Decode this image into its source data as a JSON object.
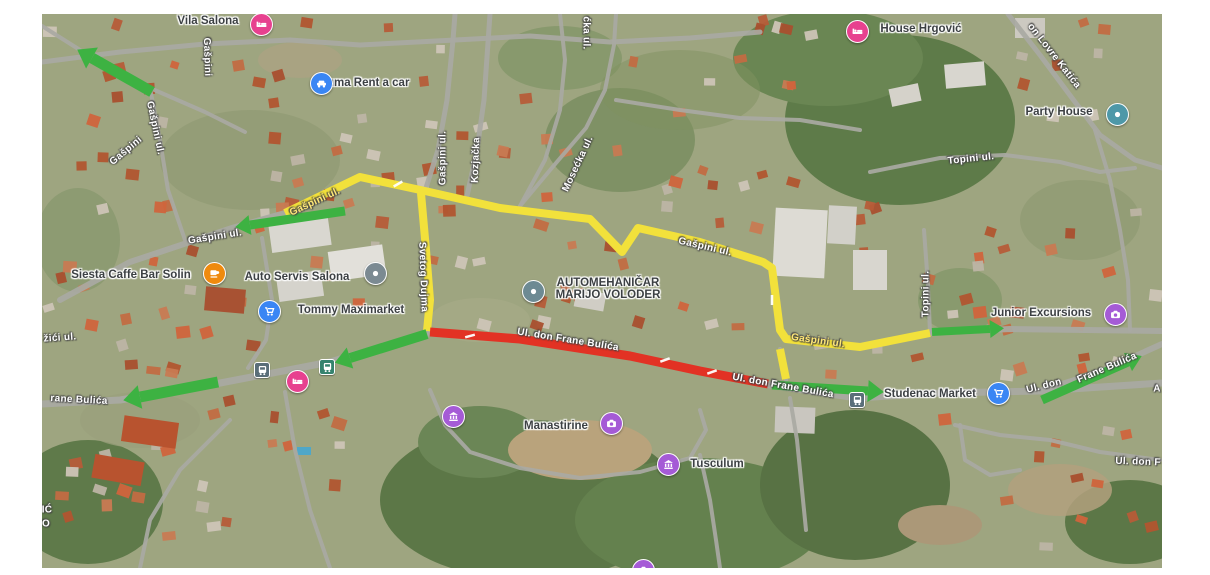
{
  "map": {
    "colors": {
      "traffic_green": "#3db242",
      "traffic_yellow": "#f2e13b",
      "traffic_red": "#e23224",
      "road": "#a9a9a3",
      "land": "#9ea580"
    },
    "street_labels": [
      {
        "text": "žići ul.",
        "x": 60,
        "y": 338,
        "rot": -4,
        "style": "white"
      },
      {
        "text": "rane Bulića",
        "x": 79,
        "y": 400,
        "rot": 3,
        "style": "white"
      },
      {
        "text": "Gašpini ul.",
        "x": 215,
        "y": 237,
        "rot": -9,
        "style": "white"
      },
      {
        "text": "Gašpini ul.",
        "x": 315,
        "y": 202,
        "rot": -25,
        "style": "on-yellow"
      },
      {
        "text": "Gašpini",
        "x": 207,
        "y": 57,
        "rot": 88,
        "style": "white"
      },
      {
        "text": "Gašpini ul.",
        "x": 155,
        "y": 128,
        "rot": 78,
        "style": "white"
      },
      {
        "text": "Gašpini",
        "x": 126,
        "y": 151,
        "rot": -40,
        "style": "white"
      },
      {
        "text": "Gašpini ul.",
        "x": 443,
        "y": 158,
        "rot": -90,
        "style": "white"
      },
      {
        "text": "Kozjačka",
        "x": 476,
        "y": 160,
        "rot": -88,
        "style": "white"
      },
      {
        "text": "ćka ul.",
        "x": 586,
        "y": 33,
        "rot": 90,
        "style": "white"
      },
      {
        "text": "Mosećka ul.",
        "x": 578,
        "y": 164,
        "rot": -65,
        "style": "white"
      },
      {
        "text": "Svetog Dujma",
        "x": 423,
        "y": 277,
        "rot": 88,
        "style": "white"
      },
      {
        "text": "Gašpini ul.",
        "x": 705,
        "y": 247,
        "rot": 13,
        "style": "white"
      },
      {
        "text": "Gašpini ul.",
        "x": 818,
        "y": 341,
        "rot": 8,
        "style": "on-yellow"
      },
      {
        "text": "Topini ul.",
        "x": 971,
        "y": 159,
        "rot": -6,
        "style": "white"
      },
      {
        "text": "Topini ul.",
        "x": 926,
        "y": 294,
        "rot": -90,
        "style": "white"
      },
      {
        "text": "on Lovre Katića",
        "x": 1054,
        "y": 56,
        "rot": 52,
        "style": "white"
      },
      {
        "text": "Ul. don Frane Bulića",
        "x": 568,
        "y": 340,
        "rot": 9,
        "style": "white"
      },
      {
        "text": "Ul. don Frane Bulića",
        "x": 783,
        "y": 386,
        "rot": 10,
        "style": "white"
      },
      {
        "text": "Ul. don",
        "x": 1044,
        "y": 386,
        "rot": -14,
        "style": "white"
      },
      {
        "text": "Frane Bulića",
        "x": 1107,
        "y": 368,
        "rot": -23,
        "style": "white"
      },
      {
        "text": "Ul. don F",
        "x": 1138,
        "y": 462,
        "rot": 2,
        "style": "white"
      },
      {
        "text": "A",
        "x": 1157,
        "y": 389,
        "rot": 0,
        "style": "white"
      },
      {
        "text": "IĆ",
        "x": 47,
        "y": 510,
        "rot": 0,
        "style": "white"
      },
      {
        "text": "O",
        "x": 46,
        "y": 524,
        "rot": 0,
        "style": "white"
      }
    ],
    "poi_labels": [
      {
        "name": "vila-salona",
        "text": "Vila Salona",
        "x": 208,
        "y": 21
      },
      {
        "name": "iluma-rent-a-car",
        "text": "Iluma Rent a car",
        "x": 365,
        "y": 83
      },
      {
        "name": "house-hrgovic",
        "text": "House Hrgović",
        "x": 921,
        "y": 29
      },
      {
        "name": "party-house",
        "text": "Party House",
        "x": 1059,
        "y": 112
      },
      {
        "name": "siesta-caffe-bar-solin",
        "text": "Siesta Caffe Bar Solin",
        "x": 131,
        "y": 275
      },
      {
        "name": "auto-servis-salona",
        "text": "Auto Servis Salona",
        "x": 297,
        "y": 277
      },
      {
        "name": "tommy-maximarket",
        "text": "Tommy Maximarket",
        "x": 351,
        "y": 310
      },
      {
        "name": "automehanicar-marijo-voloder",
        "text": "AUTOMEHANIČAR",
        "line2": "MARIJO VOLODER",
        "x": 608,
        "y": 289
      },
      {
        "name": "manastirine",
        "text": "Manastirine",
        "x": 556,
        "y": 426
      },
      {
        "name": "tusculum",
        "text": "Tusculum",
        "x": 717,
        "y": 464
      },
      {
        "name": "junior-excursions",
        "text": "Junior Excursions",
        "x": 1041,
        "y": 313
      },
      {
        "name": "studenac-market",
        "text": "Studenac Market",
        "x": 930,
        "y": 394
      }
    ],
    "markers": [
      {
        "name": "vila-salona",
        "icon": "bed",
        "color": "#e7418f",
        "x": 260,
        "y": 23
      },
      {
        "name": "iluma-rent-a-car",
        "icon": "car",
        "color": "#3a86f4",
        "x": 320,
        "y": 82
      },
      {
        "name": "house-hrgovic",
        "icon": "bed",
        "color": "#e7418f",
        "x": 856,
        "y": 30
      },
      {
        "name": "party-house",
        "icon": "dot",
        "color": "#4e98a8",
        "x": 1116,
        "y": 113
      },
      {
        "name": "siesta-caffe-bar-solin",
        "icon": "cup",
        "color": "#ef8a0e",
        "x": 213,
        "y": 272
      },
      {
        "name": "auto-servis-salona",
        "icon": "dot",
        "color": "#7b8a92",
        "x": 374,
        "y": 272
      },
      {
        "name": "tommy-maximarket",
        "icon": "cart",
        "color": "#3a86f4",
        "x": 268,
        "y": 310
      },
      {
        "name": "automehanicar-marijo-voloder",
        "icon": "dot",
        "color": "#6d8a93",
        "x": 532,
        "y": 290
      },
      {
        "name": "manastirine",
        "icon": "camera",
        "color": "#a55bd6",
        "x": 610,
        "y": 422
      },
      {
        "name": "tusculum",
        "icon": "museum",
        "color": "#a55bd6",
        "x": 667,
        "y": 463
      },
      {
        "name": "museum-west",
        "icon": "museum",
        "color": "#a55bd6",
        "x": 452,
        "y": 415
      },
      {
        "name": "camera-south",
        "icon": "camera",
        "color": "#a55bd6",
        "x": 642,
        "y": 569
      },
      {
        "name": "junior-excursions",
        "icon": "camera",
        "color": "#a55bd6",
        "x": 1114,
        "y": 313
      },
      {
        "name": "studenac-market",
        "icon": "cart",
        "color": "#3a86f4",
        "x": 997,
        "y": 392
      },
      {
        "name": "lodging-bulica",
        "icon": "bed",
        "color": "#e7418f",
        "x": 296,
        "y": 380
      }
    ],
    "transit_stops": [
      {
        "name": "bus-stop-west",
        "color": "#5a6e79",
        "x": 261,
        "y": 369
      },
      {
        "name": "bus-stop-center",
        "color": "#35836e",
        "x": 326,
        "y": 366
      },
      {
        "name": "bus-stop-studenac",
        "color": "#5a6e79",
        "x": 856,
        "y": 399
      }
    ],
    "routes": {
      "yellow_segments": [
        [
          [
            285,
            213
          ],
          [
            360,
            177
          ],
          [
            425,
            191
          ],
          [
            500,
            208
          ],
          [
            590,
            219
          ],
          [
            622,
            252
          ],
          [
            638,
            228
          ],
          [
            700,
            242
          ],
          [
            763,
            262
          ],
          [
            772,
            268
          ],
          [
            780,
            330
          ],
          [
            786,
            339
          ],
          [
            860,
            347
          ],
          [
            930,
            333
          ]
        ],
        [
          [
            421,
            193
          ],
          [
            426,
            250
          ],
          [
            430,
            300
          ],
          [
            427,
            331
          ]
        ],
        [
          [
            780,
            349
          ],
          [
            786,
            379
          ]
        ]
      ],
      "red_segments": [
        [
          [
            430,
            332
          ],
          [
            520,
            339
          ],
          [
            630,
            356
          ],
          [
            700,
            371
          ],
          [
            768,
            384
          ]
        ]
      ],
      "green_arrows": [
        {
          "pts": [
            [
              152,
              92
            ],
            [
              92,
              58
            ]
          ],
          "w": 11,
          "hl": 17,
          "hw": 12
        },
        {
          "pts": [
            [
              345,
              211
            ],
            [
              250,
              225
            ]
          ],
          "w": 9,
          "hl": 15,
          "hw": 10
        },
        {
          "pts": [
            [
              427,
              334
            ],
            [
              350,
              358
            ]
          ],
          "w": 10,
          "hl": 16,
          "hw": 11
        },
        {
          "pts": [
            [
              218,
              382
            ],
            [
              140,
              397
            ]
          ],
          "w": 11,
          "hl": 17,
          "hw": 12
        },
        {
          "pts": [
            [
              772,
              385
            ],
            [
              868,
              391
            ]
          ],
          "w": 9,
          "hl": 16,
          "hw": 11
        },
        {
          "pts": [
            [
              1042,
              400
            ],
            [
              1128,
              362
            ]
          ],
          "w": 9,
          "hl": 15,
          "hw": 10
        },
        {
          "pts": [
            [
              932,
              332
            ],
            [
              990,
              329
            ]
          ],
          "w": 8,
          "hl": 14,
          "hw": 9
        }
      ],
      "segment_ticks": [
        {
          "x": 470,
          "y": 336,
          "rot": 75
        },
        {
          "x": 665,
          "y": 360,
          "rot": 70
        },
        {
          "x": 712,
          "y": 372,
          "rot": 70
        },
        {
          "x": 398,
          "y": 184,
          "rot": 60
        },
        {
          "x": 424,
          "y": 255,
          "rot": 0
        },
        {
          "x": 772,
          "y": 300,
          "rot": 0
        }
      ]
    }
  }
}
